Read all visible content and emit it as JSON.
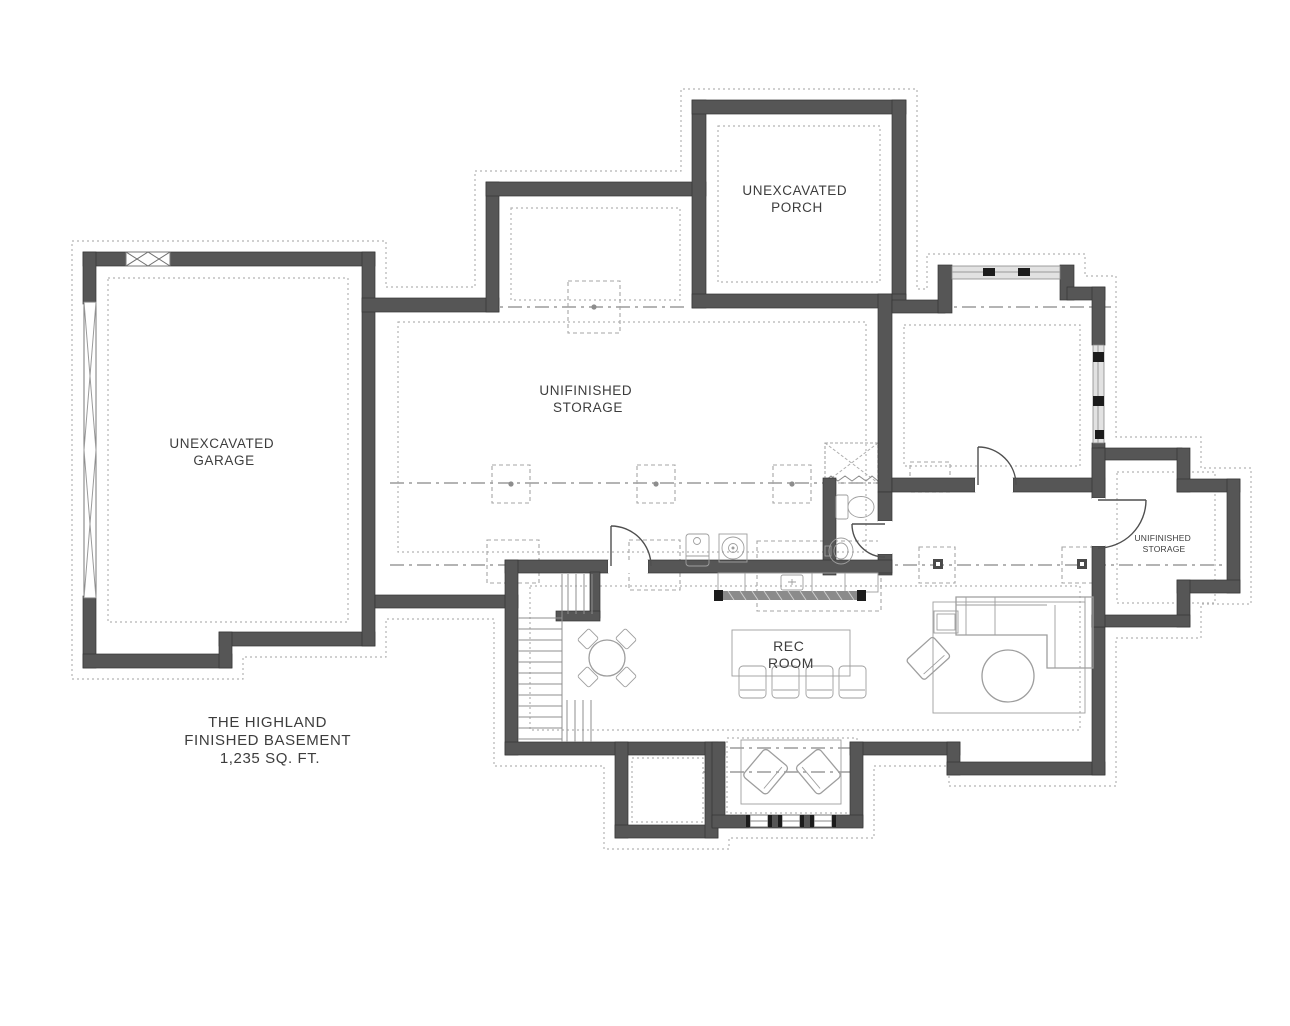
{
  "plan": {
    "name": "floor-plan",
    "labels": {
      "garage": [
        "UNEXCAVATED",
        "GARAGE"
      ],
      "porch": [
        "UNEXCAVATED",
        "PORCH"
      ],
      "storage_main": [
        "UNIFINISHED",
        "STORAGE"
      ],
      "rec_room": [
        "REC",
        "ROOM"
      ],
      "storage_right": [
        "UNIFINISHED",
        "STORAGE"
      ],
      "title": [
        "THE HIGHLAND",
        "FINISHED BASEMENT",
        "1,235 SQ. FT."
      ]
    }
  },
  "colors": {
    "wall": "#565656",
    "wallEdge": "#353535",
    "furn": "#9e9e9e",
    "footing": "#b5b5b5",
    "centerline": "#9c9c9c",
    "textcol": "#3d3d3d",
    "bg": "#ffffff",
    "window": "#e2e2e2"
  }
}
